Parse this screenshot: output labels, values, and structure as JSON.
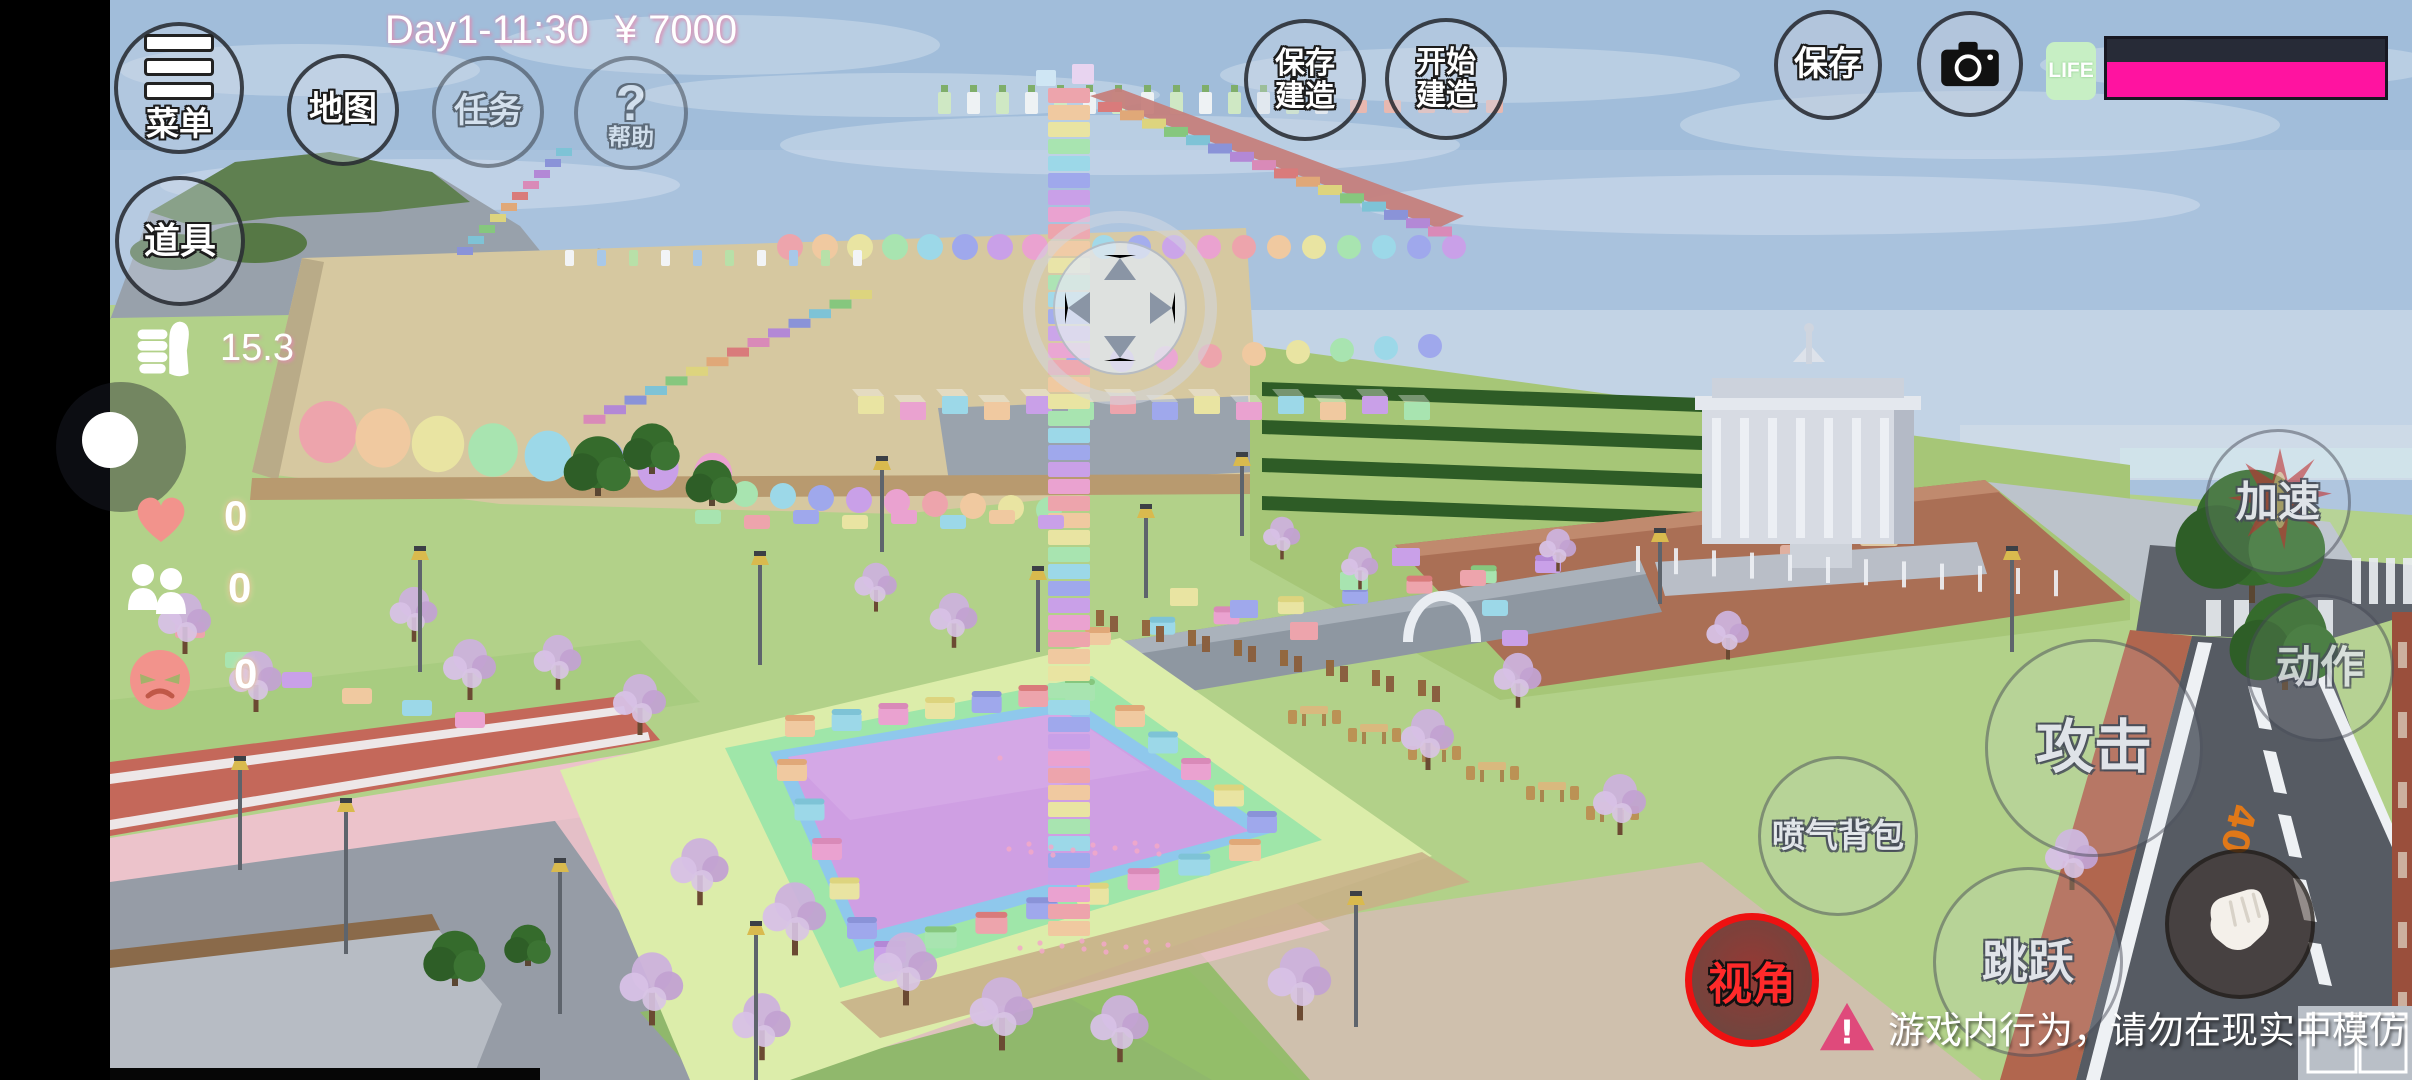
{
  "status_bar": {
    "day_time": "Day1-11:30",
    "money": "¥ 7000"
  },
  "top_left": {
    "menu": "菜单",
    "map": "地图",
    "task": "任务",
    "help_symbol": "?",
    "help": "帮助",
    "props": "道具"
  },
  "reputation": {
    "icon": "thumbs-up-icon",
    "value": "15.3"
  },
  "stats": [
    {
      "icon": "heart-icon",
      "value": "0"
    },
    {
      "icon": "two-people-icon",
      "value": "0"
    },
    {
      "icon": "angry-face-icon",
      "value": "0"
    }
  ],
  "build_controls": {
    "save_build": {
      "line1": "保存",
      "line2": "建造"
    },
    "start_build": {
      "line1": "开始",
      "line2": "建造"
    }
  },
  "top_right": {
    "save": "保存",
    "camera_icon": "camera-icon",
    "life_label": "LIFE",
    "life_percent": 100
  },
  "action_buttons": {
    "accelerate": "加速",
    "action": "动作",
    "attack": "攻击",
    "jetpack": "喷气背包",
    "jump": "跳跃",
    "view": "视角",
    "punch_icon": "fist-icon"
  },
  "warning": {
    "symbol": "!",
    "text": "游戏内行为，请勿在现实中模仿"
  },
  "scene": {
    "road_speed_marking": "40"
  },
  "colors": {
    "life_bar_fill": "#ff13a0",
    "life_bar_back": "#272b37",
    "life_label_bg": "#c7efc4",
    "view_ring": "#ee1111",
    "view_text": "#ff2a2a",
    "warning_triangle": "#df4a7b",
    "status_text_shadow": "#e08bb0",
    "heart_pink": "#f2938c",
    "pool_water": "#cf9fe3"
  }
}
